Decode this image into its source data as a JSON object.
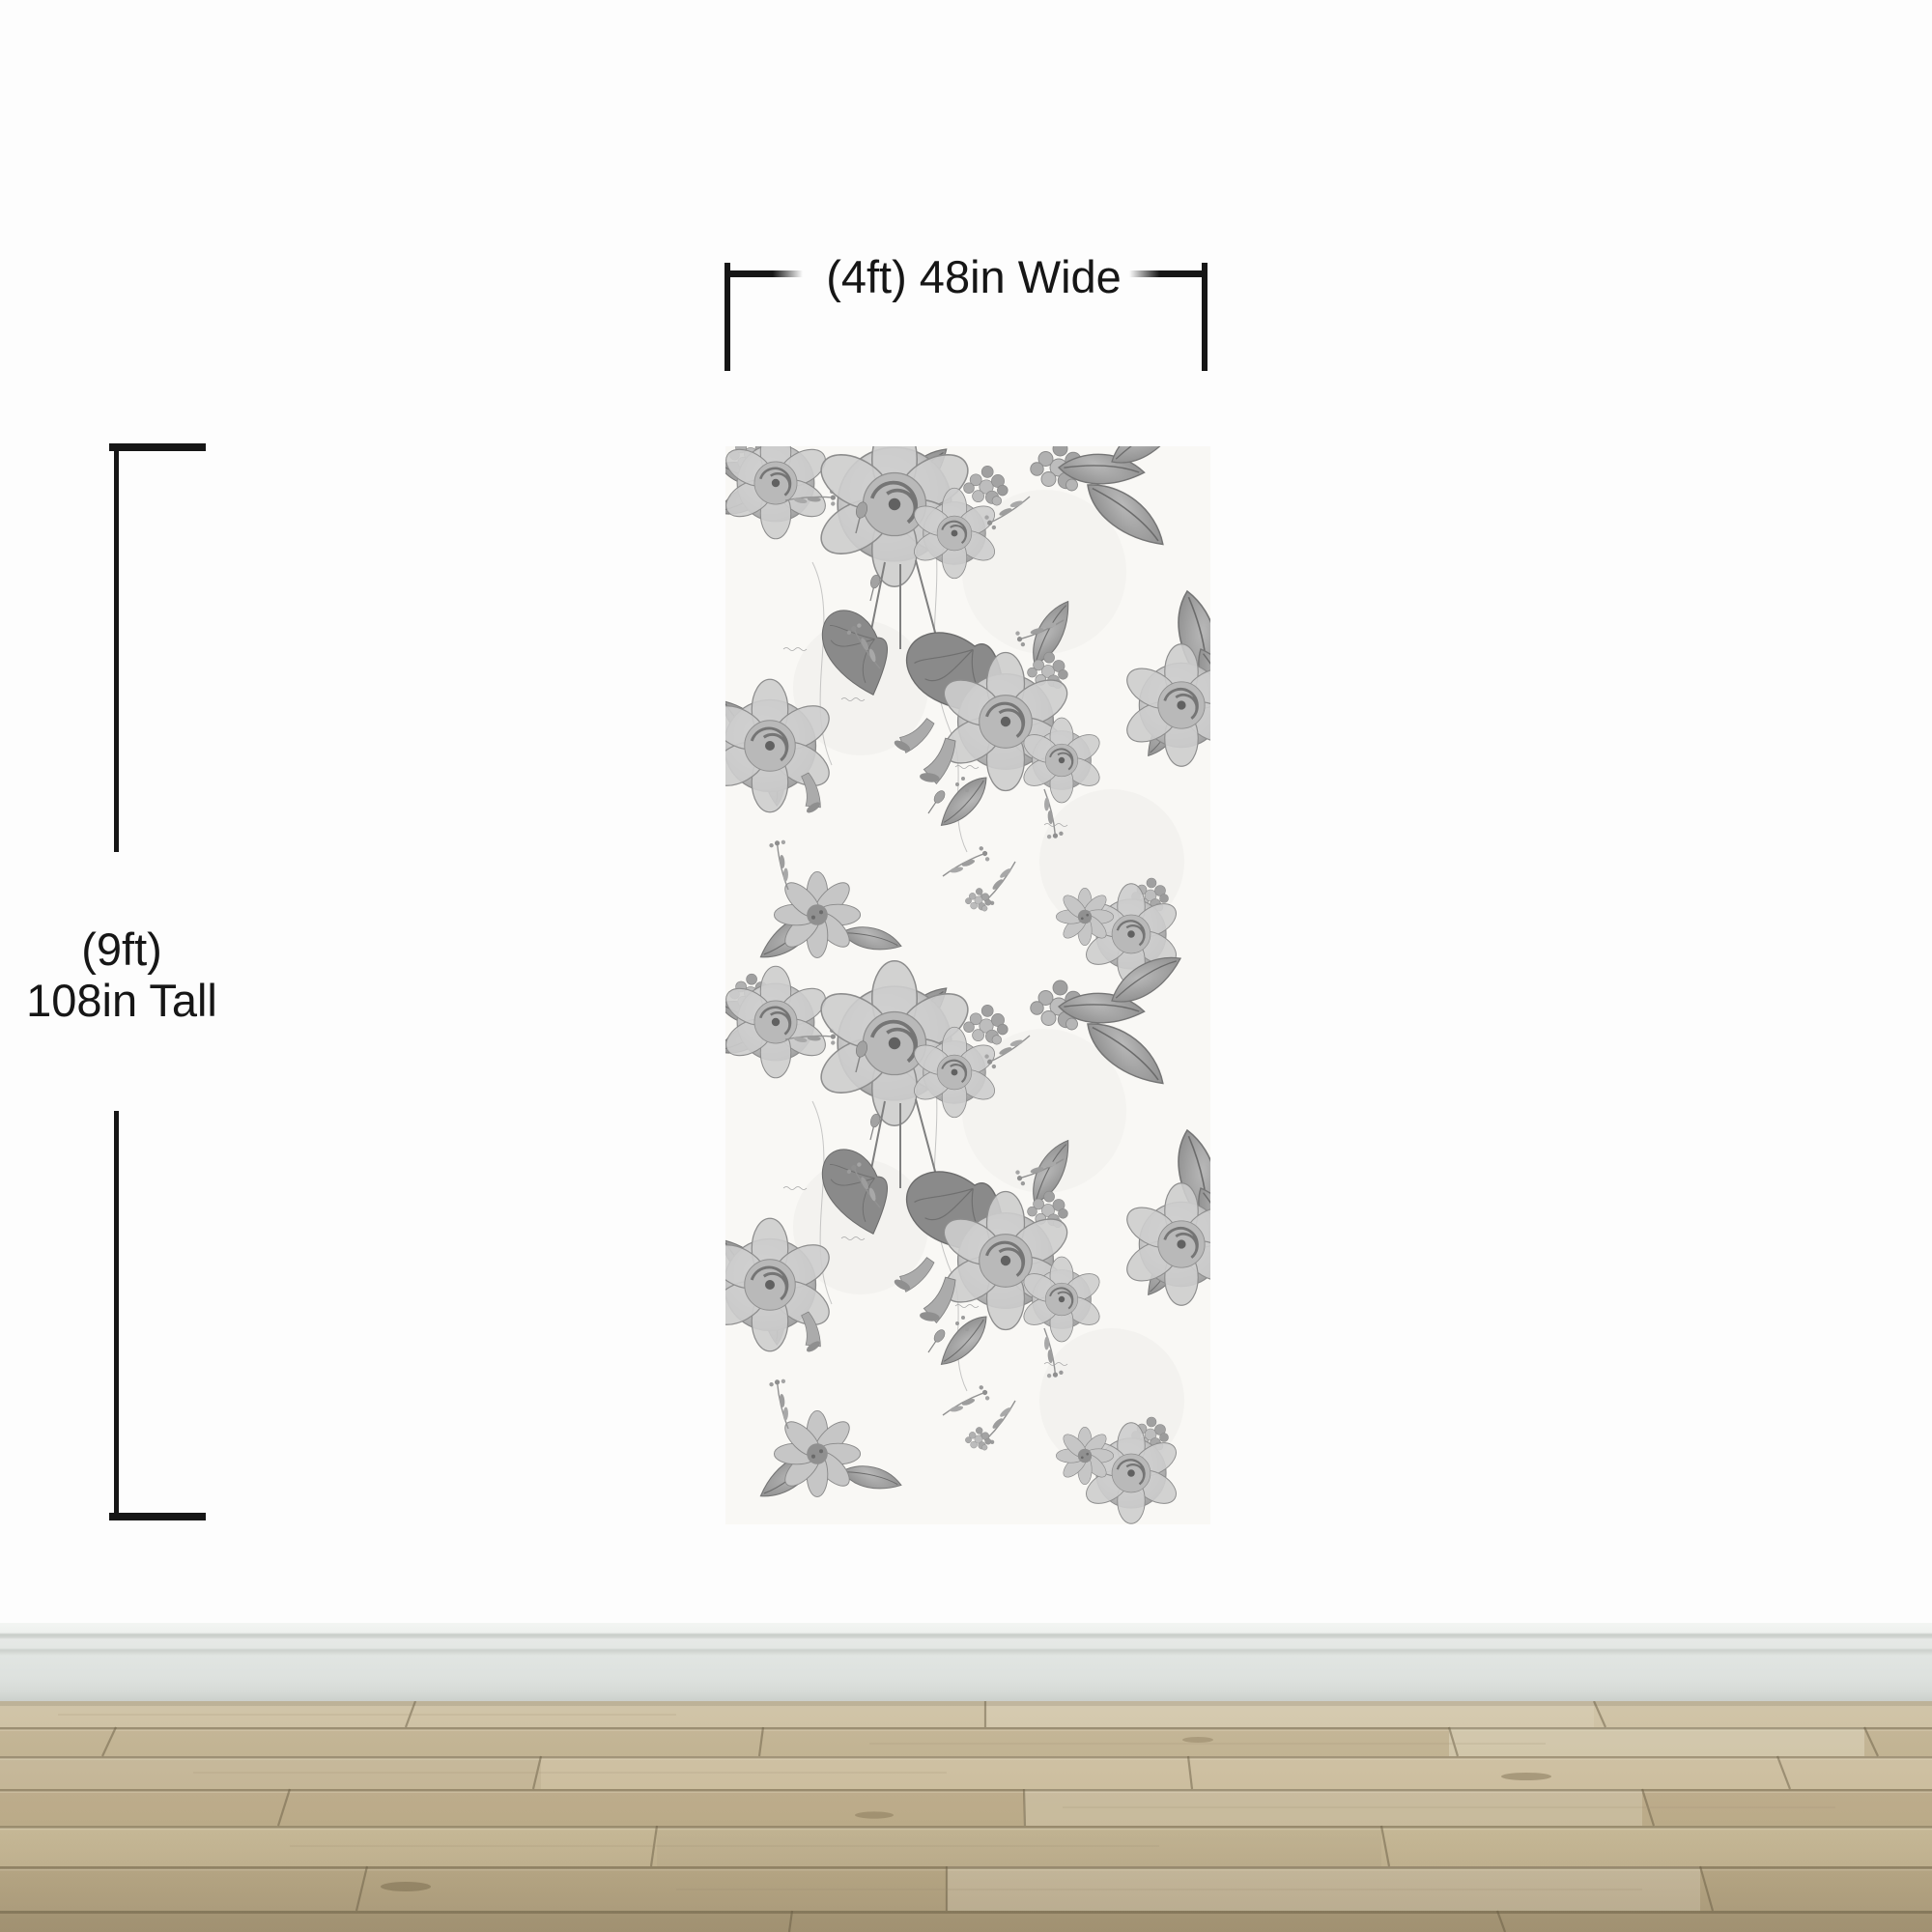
{
  "wallpaper": {
    "name": "vintage-black-white-floral-wallpaper-panel"
  },
  "annotations": {
    "width_label": "(4ft) 48in Wide",
    "height_line1": "(9ft)",
    "height_line2": "108in Tall"
  },
  "colors": {
    "wall": "#fdfdfd",
    "dimension_ink": "#161616",
    "baseboard_face": "#dfe3e0",
    "baseboard_shadow": "#cfd4d0",
    "floor_base": "#c4b492",
    "floor_seam": "#6b5f46",
    "panel_background": "#f9f8f5",
    "pattern_ink_dark": "#6e6e6e",
    "pattern_ink_mid": "#9a9a9a",
    "pattern_ink_light": "#cccccc"
  }
}
